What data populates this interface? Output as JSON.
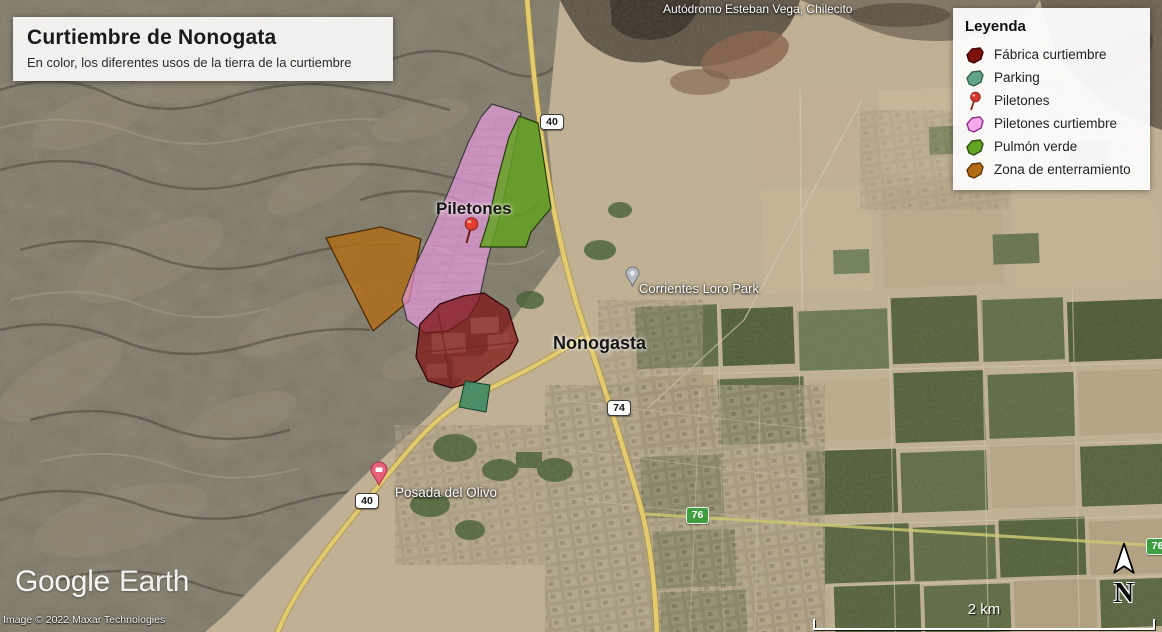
{
  "title_box": {
    "title": "Curtiembre de Nonogata",
    "subtitle": "En color, los diferentes usos de la tierra de la curtiembre"
  },
  "legend": {
    "title": "Leyenda",
    "items": [
      {
        "label": "Fábrica curtiembre",
        "color": "#7d0f0f",
        "stroke": "#3f0505",
        "type": "polygon"
      },
      {
        "label": "Parking",
        "color": "#63a489",
        "stroke": "#34664f",
        "type": "polygon"
      },
      {
        "label": "Piletones",
        "color": "#d5382e",
        "stroke": "#8e1f14",
        "type": "pushpin"
      },
      {
        "label": "Piletones curtiembre",
        "color": "#f6a8ef",
        "stroke": "#8f2d88",
        "type": "polygon"
      },
      {
        "label": "Pulmón verde",
        "color": "#61a41f",
        "stroke": "#2e4b10",
        "type": "polygon"
      },
      {
        "label": "Zona de enterramiento",
        "color": "#b26b12",
        "stroke": "#5d3706",
        "type": "polygon"
      }
    ]
  },
  "map_labels": {
    "autodromo": "Autódromo Esteban Vega, Chilecito",
    "piletones": "Piletones",
    "corrientes": "Corrientes Loro Park",
    "nonogasta": "Nonogasta",
    "posada": "Posada del Olivo"
  },
  "route_badges": {
    "r40_top": "40",
    "r74": "74",
    "r40_sw": "40",
    "r76": "76",
    "r76_edge": "76"
  },
  "zones": {
    "fabrica": {
      "name": "Fábrica curtiembre",
      "color": "#7d0f0f"
    },
    "parking": {
      "name": "Parking",
      "color": "#3e8a63"
    },
    "piletones_curtiembre": {
      "name": "Piletones curtiembre",
      "color": "#f2a0ec"
    },
    "pulmon_verde": {
      "name": "Pulmón verde",
      "color": "#61a41f"
    },
    "zona_enterramiento": {
      "name": "Zona de enterramiento",
      "color": "#b26b12"
    }
  },
  "attribution": {
    "logo_word1": "Google",
    "logo_word2": "Earth",
    "copyright": "Image © 2022 Maxar Technologies"
  },
  "scale_bar": {
    "label": "2 km"
  },
  "north_arrow": {
    "label": "N"
  }
}
